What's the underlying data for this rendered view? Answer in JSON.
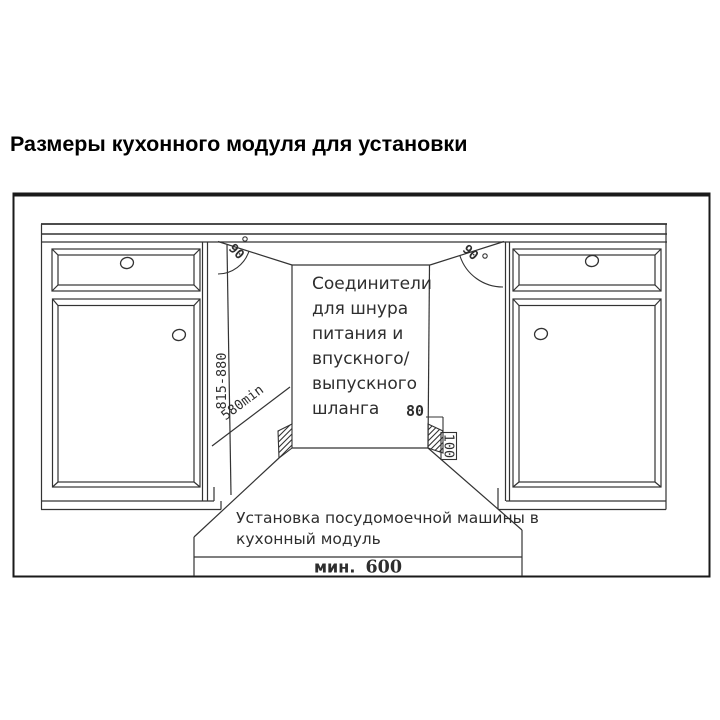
{
  "page": {
    "title": "Размеры кухонного модуля для установки"
  },
  "diagram": {
    "connector_note": {
      "line1": "Соединители",
      "line2": "для шнура",
      "line3": "питания и",
      "line4": "впускного/",
      "line5": "выпускного",
      "line6": "шланга"
    },
    "install_note": {
      "line1": "Установка посудомоечной машины в",
      "line2": "кухонный модуль"
    },
    "dimensions": {
      "niche_height": "815-880",
      "niche_depth": "580min",
      "block_width": "80",
      "block_height": "100",
      "min_width_label": "мин.",
      "min_width_value": "600",
      "angle_left": "90",
      "angle_right": "90"
    },
    "colors": {
      "line": "#333333",
      "frame": "#1a1a1a",
      "text": "#2e2e2e"
    }
  }
}
